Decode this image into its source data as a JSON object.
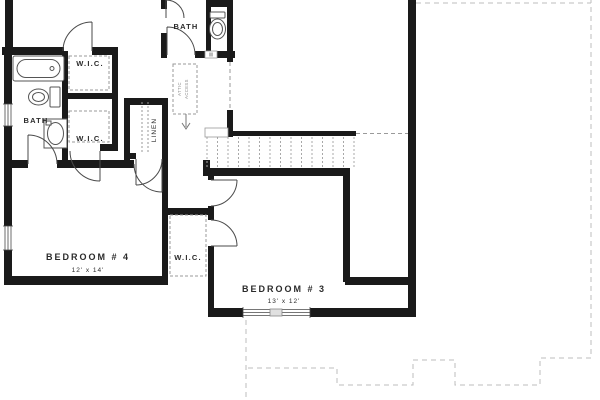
{
  "plan": {
    "kind": "residential-floor-plan",
    "rooms": {
      "bath_left": {
        "label": "BATH"
      },
      "wic_1": {
        "label": "W.I.C."
      },
      "wic_2": {
        "label": "W.I.C."
      },
      "linen": {
        "label": "LINEN"
      },
      "bath_hall": {
        "label": "BATH"
      },
      "bedroom_4": {
        "label": "BEDROOM # 4",
        "dims": "12' x 14'"
      },
      "bedroom_3": {
        "label": "BEDROOM # 3",
        "dims": "13' x 12'"
      },
      "wic_3": {
        "label": "W.I.C."
      },
      "attic": {
        "line1": "ATTIC",
        "line2": "ACCESS"
      }
    },
    "colors": {
      "wall": "#1a1a1a",
      "line": "#4a4a4a",
      "fixture": "#555555",
      "dashed": "#9a9a9a",
      "tread": "#a8a8a8",
      "roof": "#bdbdbd",
      "text": "#2b2b2b",
      "text_faint": "#8a8a8a"
    }
  }
}
